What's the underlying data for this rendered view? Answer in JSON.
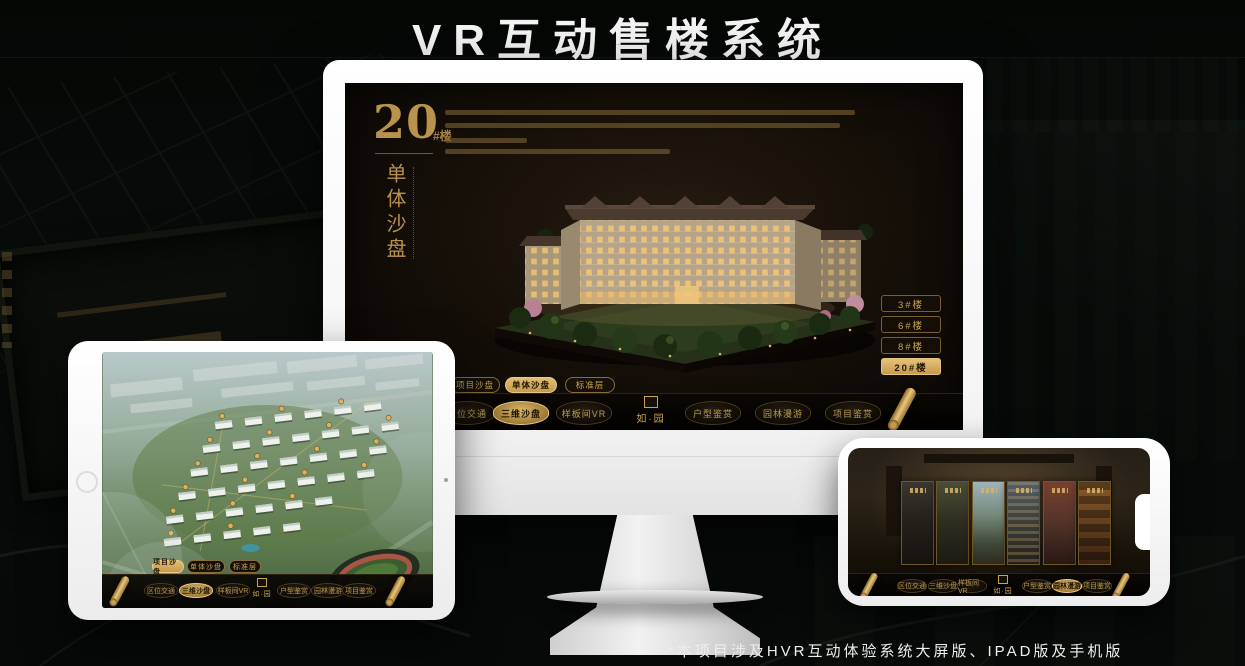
{
  "page": {
    "title": "VR互动售楼系统",
    "footnote": "*本项目涉及HVR互动体验系统大屏版、IPAD版及手机版"
  },
  "brand": {
    "logo_text": "如·园",
    "gold_accent": "#c9a44d",
    "gold_active": "#d9b365",
    "screen_bg": "#15100a"
  },
  "monitor_app": {
    "hero_number": "20",
    "hero_suffix": "#楼",
    "hero_subtitle": "单体沙盘",
    "floor_buttons": [
      {
        "label": "3#楼",
        "active": false
      },
      {
        "label": "6#楼",
        "active": false
      },
      {
        "label": "8#楼",
        "active": false
      },
      {
        "label": "20#楼",
        "active": true
      }
    ],
    "mode_tabs": [
      {
        "label": "项目沙盘",
        "active": false
      },
      {
        "label": "单体沙盘",
        "active": true
      },
      {
        "label": "标准层",
        "active": false
      }
    ],
    "menu_left": [
      {
        "label": "区位交通",
        "active": false
      },
      {
        "label": "三维沙盘",
        "active": true
      },
      {
        "label": "样板间VR",
        "active": false
      }
    ],
    "menu_right": [
      {
        "label": "户型鉴赏",
        "active": false
      },
      {
        "label": "园林漫游",
        "active": false
      },
      {
        "label": "项目鉴赏",
        "active": false
      }
    ]
  },
  "tablet_app": {
    "mode_tabs": [
      {
        "label": "项目沙盘",
        "active": true
      },
      {
        "label": "单体沙盘",
        "active": false
      },
      {
        "label": "标准层",
        "active": false
      }
    ],
    "menu_left": [
      {
        "label": "区位交通",
        "active": false
      },
      {
        "label": "三维沙盘",
        "active": true
      },
      {
        "label": "样板间VR",
        "active": false
      }
    ],
    "menu_right": [
      {
        "label": "户型鉴赏",
        "active": false
      },
      {
        "label": "园林漫游",
        "active": false
      },
      {
        "label": "项目鉴赏",
        "active": false
      }
    ]
  },
  "phone_app": {
    "menu_left": [
      {
        "label": "区位交通",
        "active": false
      },
      {
        "label": "三维沙盘",
        "active": false
      },
      {
        "label": "样板间VR",
        "active": false
      }
    ],
    "menu_right": [
      {
        "label": "户型鉴赏",
        "active": false
      },
      {
        "label": "园林漫游",
        "active": true
      },
      {
        "label": "项目鉴赏",
        "active": false
      }
    ]
  }
}
